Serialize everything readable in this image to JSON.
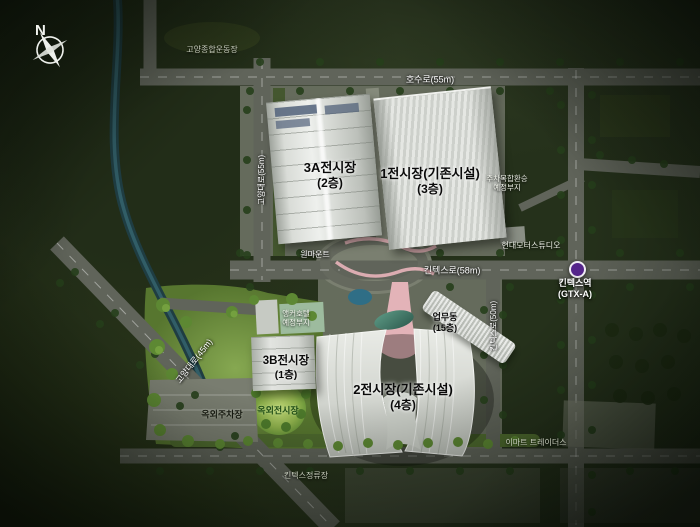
{
  "compass": {
    "north": "N"
  },
  "road_labels": {
    "hosu": "호수로(55m)",
    "goyang_55": "고양대로(55m)",
    "kintex_58": "킨텍스로(58m)",
    "kintex_50": "킨텍스로(50m)",
    "goyang_45": "고양대로(45m)"
  },
  "buildings": {
    "hall_3a": {
      "name": "3A전시장",
      "floors": "(2층)"
    },
    "hall_1": {
      "name": "1전시장(기존시설)",
      "floors": "(3층)"
    },
    "hall_3b": {
      "name": "3B전시장",
      "floors": "(1층)"
    },
    "hall_2": {
      "name": "2전시장(기존시설)",
      "floors": "(4층)"
    },
    "office": {
      "name": "업무동",
      "floors": "(15층)"
    }
  },
  "places": {
    "stadium": "고양종합운동장",
    "onemount": "원마운트",
    "hyundai_motorstudio": "현대모터스튜디오",
    "parking_transfer_site": {
      "line1": "주차복합환승",
      "line2": "예정부지"
    },
    "anchor_hotel_site": {
      "line1": "앵커호텔",
      "line2": "예정부지"
    },
    "outdoor_parking": "옥외주차장",
    "outdoor_exhibition": "옥외전시장",
    "bus_stop": "킨텍스정류장",
    "emart": "이마트 트레이더스"
  },
  "station": {
    "name": "킨텍스역",
    "line": "(GTX-A)",
    "marker_color": "#55258b"
  },
  "colors": {
    "pink_walkway": "#e3b3b8",
    "water": "#2f6e86",
    "road": "#60645a",
    "building_roof": "#dfe1dc",
    "lawn": "#86a851"
  }
}
